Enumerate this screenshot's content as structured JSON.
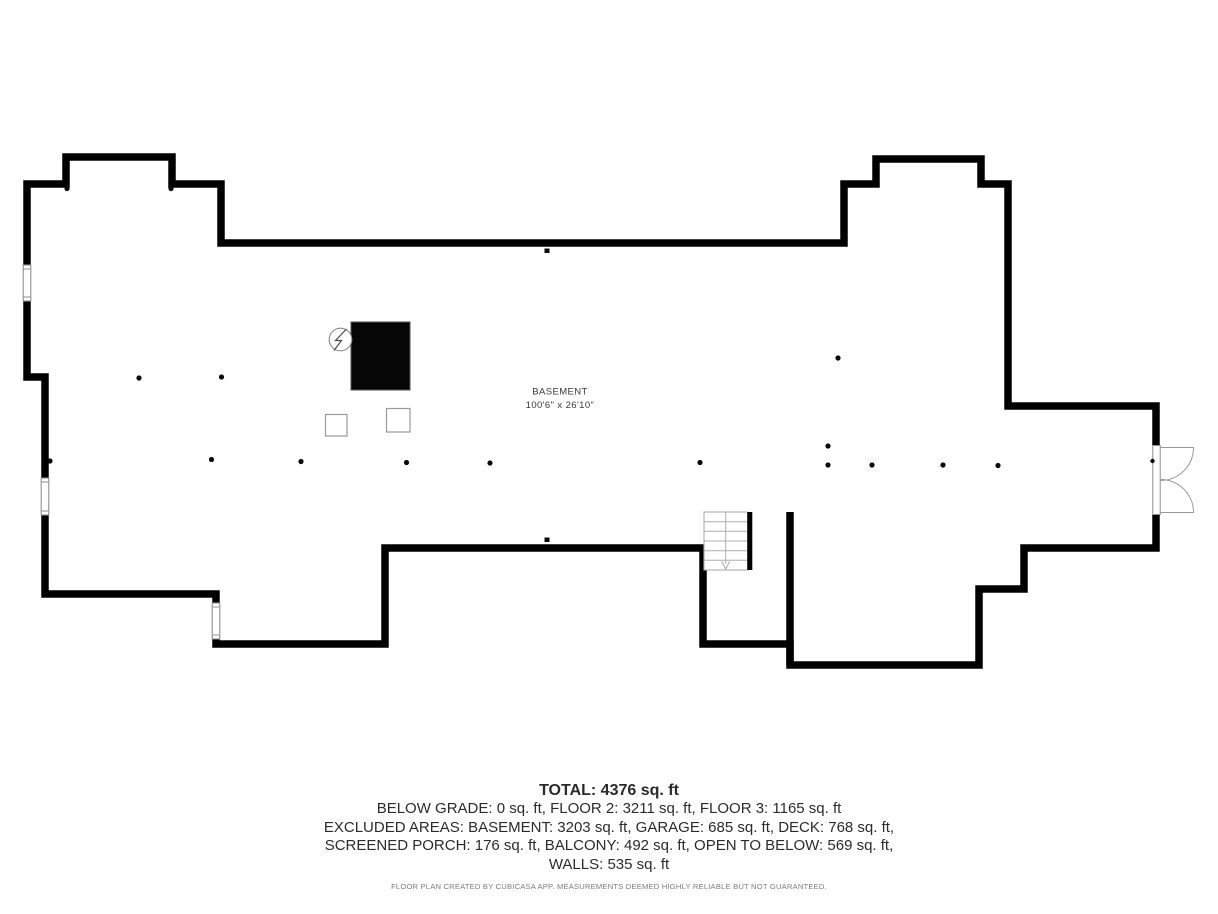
{
  "plan": {
    "room_label": "BASEMENT",
    "room_dimensions": "100'6\" x 26'10\"",
    "stairs_direction": "down",
    "colors": {
      "walls": "#000000",
      "fixtures": "#9a9a9a",
      "chimney_fill": "#060606",
      "text": "#3a3a3a"
    }
  },
  "summary": {
    "total_line": "TOTAL: 4376 sq. ft",
    "lines": [
      "BELOW GRADE: 0 sq. ft, FLOOR 2: 3211 sq. ft, FLOOR 3: 1165 sq. ft",
      "EXCLUDED AREAS: BASEMENT: 3203 sq. ft, GARAGE: 685 sq. ft, DECK: 768 sq. ft,",
      "SCREENED PORCH: 176 sq. ft, BALCONY: 492 sq. ft, OPEN TO BELOW: 569 sq. ft,",
      "WALLS: 535 sq. ft"
    ]
  },
  "footer": {
    "disclaimer": "FLOOR PLAN CREATED BY CUBICASA APP. MEASUREMENTS DEEMED HIGHLY RELIABLE BUT NOT GUARANTEED."
  }
}
